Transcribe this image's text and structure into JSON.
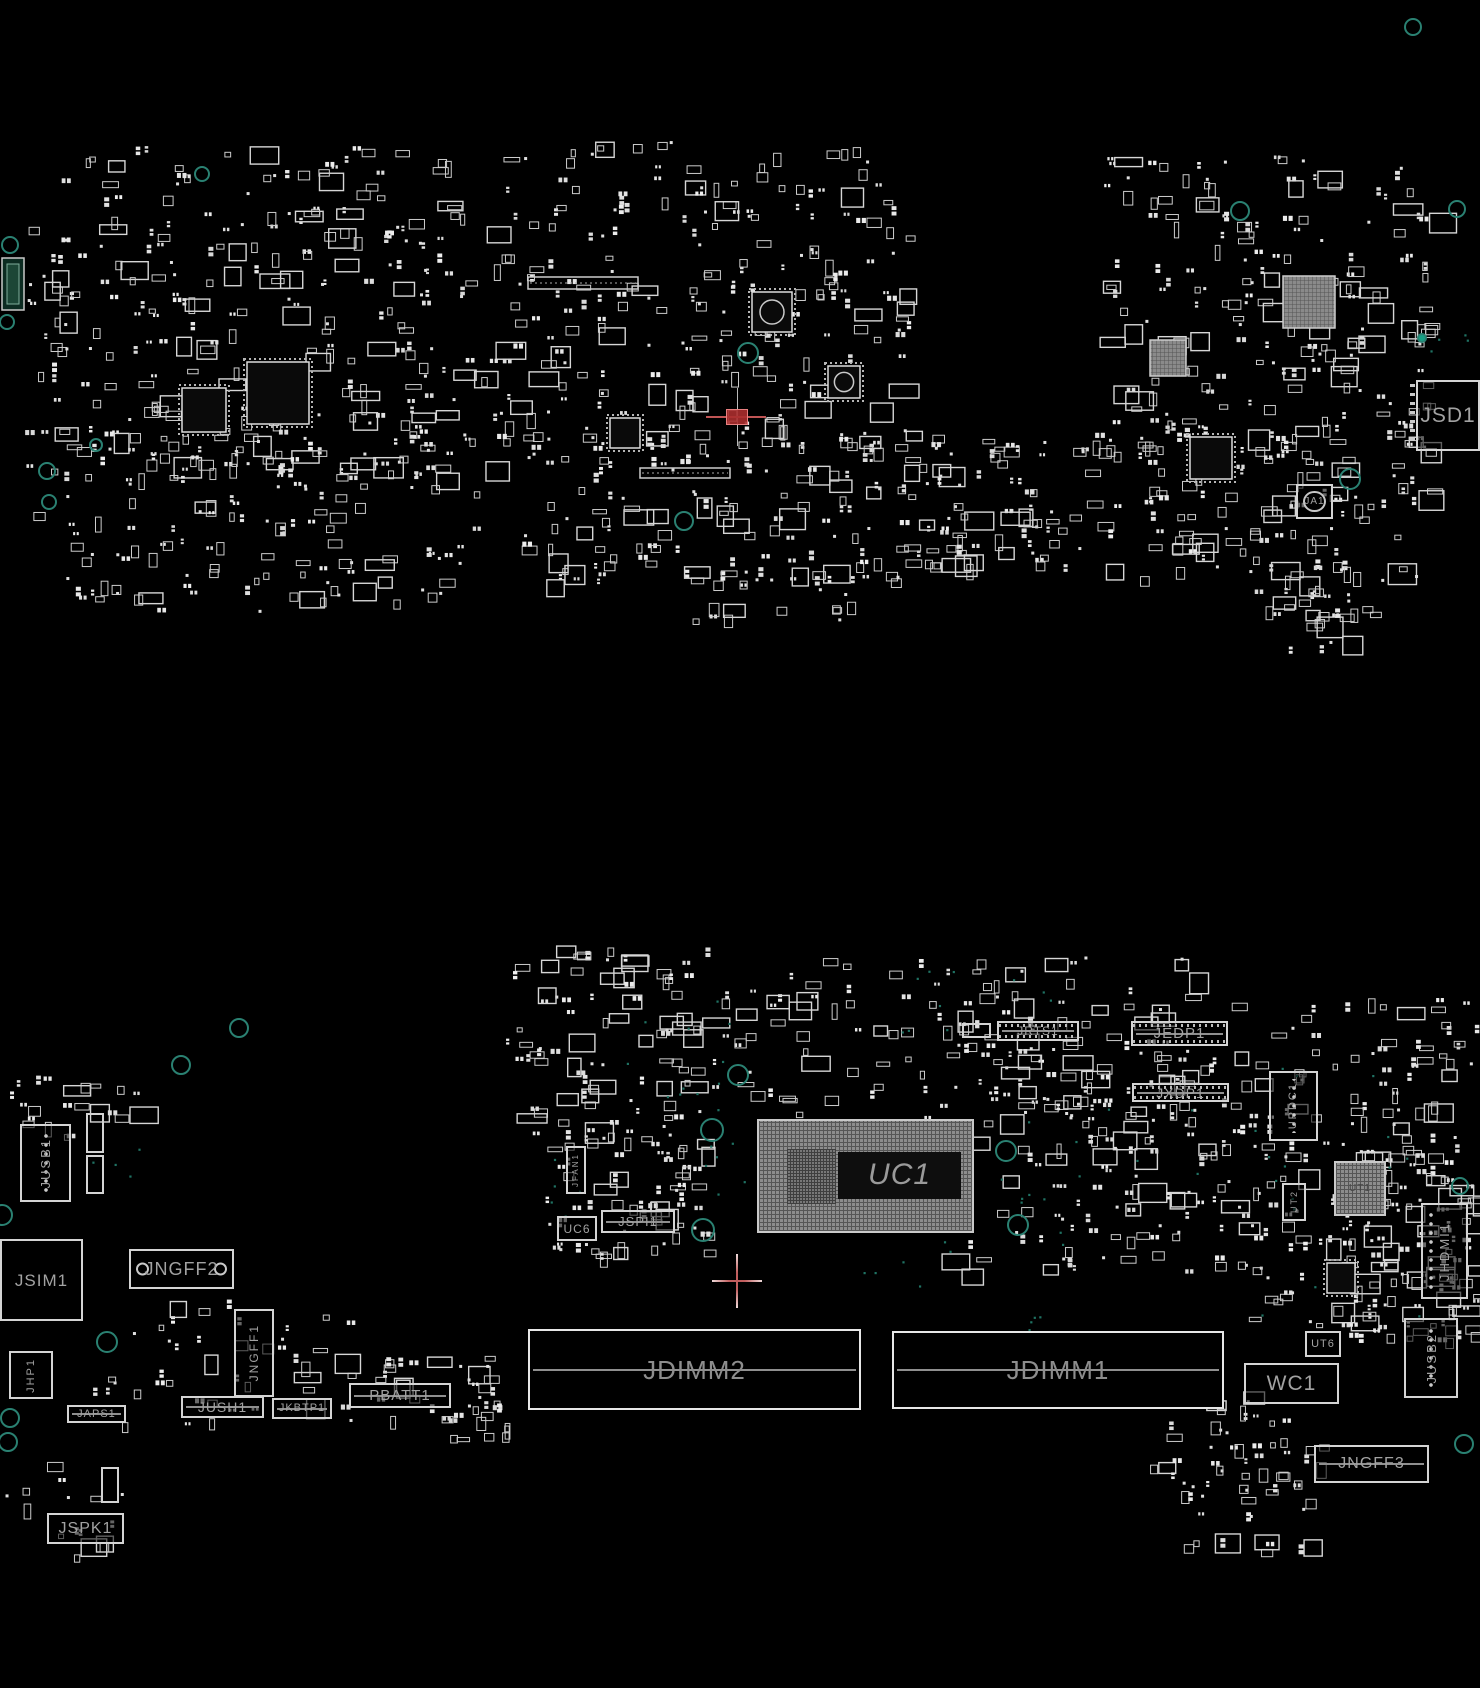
{
  "colors": {
    "background": "#000000",
    "silkscreen": "#d4d4d4",
    "label_gray": "#a2a2a2",
    "via_teal": "#2a8172",
    "crosshair_pink": "#c25e5e",
    "selection_red": "#aa2d2d"
  },
  "components": [
    {
      "label": "JSD1",
      "x": 1416,
      "y": 380,
      "w": 64,
      "h": 71,
      "fs": 21,
      "cls": "tick-l"
    },
    {
      "label": "JA1",
      "x": 1296,
      "y": 484,
      "w": 37,
      "h": 35,
      "fs": 10,
      "cls": "ring"
    },
    {
      "label": "JRTS1",
      "x": 997,
      "y": 1021,
      "w": 82,
      "h": 20,
      "fs": 12,
      "cls": "pins",
      "line": 1
    },
    {
      "label": "",
      "x": 962,
      "y": 1023,
      "w": 29,
      "h": 15
    },
    {
      "label": "JEDP1",
      "x": 1131,
      "y": 1021,
      "w": 97,
      "h": 25,
      "fs": 15,
      "cls": "pins",
      "line": 1
    },
    {
      "label": "JXDP1",
      "x": 1132,
      "y": 1083,
      "w": 97,
      "h": 19,
      "fs": 14,
      "cls": "pins",
      "line": 1
    },
    {
      "label": "UPDC1",
      "x": 1269,
      "y": 1071,
      "w": 49,
      "h": 70,
      "fs": 11,
      "cls": "vert",
      "holes": "c"
    },
    {
      "label": "UC1",
      "x": 757,
      "y": 1119,
      "w": 217,
      "h": 114,
      "fs": 30,
      "cls": "bga",
      "inner": 1
    },
    {
      "label": "UT1",
      "x": 1334,
      "y": 1161,
      "w": 52,
      "h": 55,
      "fs": 10,
      "cls": "bga faint"
    },
    {
      "label": "UT2",
      "x": 1282,
      "y": 1183,
      "w": 24,
      "h": 38,
      "fs": 9,
      "cls": "vert"
    },
    {
      "label": "JHDMI1",
      "x": 1421,
      "y": 1203,
      "w": 47,
      "h": 96,
      "fs": 13,
      "cls": "vert",
      "holes": "l"
    },
    {
      "label": "JUSB1",
      "x": 20,
      "y": 1124,
      "w": 51,
      "h": 78,
      "fs": 13,
      "cls": "vert",
      "holes": "c"
    },
    {
      "label": "",
      "x": 86,
      "y": 1113,
      "w": 18,
      "h": 40
    },
    {
      "label": "",
      "x": 86,
      "y": 1155,
      "w": 18,
      "h": 39
    },
    {
      "label": "JSIM1",
      "x": 0,
      "y": 1239,
      "w": 83,
      "h": 82,
      "fs": 17
    },
    {
      "label": "JNGFF2",
      "x": 129,
      "y": 1249,
      "w": 105,
      "h": 40,
      "fs": 18,
      "holes": "ends"
    },
    {
      "label": "JNGFF1",
      "x": 234,
      "y": 1309,
      "w": 40,
      "h": 88,
      "fs": 12,
      "cls": "vert"
    },
    {
      "label": "JHP1",
      "x": 9,
      "y": 1351,
      "w": 44,
      "h": 48,
      "fs": 11,
      "cls": "vert"
    },
    {
      "label": "JAPS1",
      "x": 67,
      "y": 1405,
      "w": 59,
      "h": 18,
      "fs": 11,
      "line": 1
    },
    {
      "label": "JUSH1",
      "x": 181,
      "y": 1396,
      "w": 83,
      "h": 22,
      "fs": 14,
      "line": 1
    },
    {
      "label": "JKBTP1",
      "x": 272,
      "y": 1398,
      "w": 60,
      "h": 21,
      "fs": 11,
      "line": 1
    },
    {
      "label": "PBATT1",
      "x": 349,
      "y": 1383,
      "w": 102,
      "h": 25,
      "fs": 15,
      "line": 1
    },
    {
      "label": "JSPK1",
      "x": 47,
      "y": 1513,
      "w": 77,
      "h": 31,
      "fs": 16
    },
    {
      "label": "",
      "x": 101,
      "y": 1467,
      "w": 18,
      "h": 36
    },
    {
      "label": "JDIMM2",
      "x": 528,
      "y": 1329,
      "w": 333,
      "h": 81,
      "fs": 26,
      "cls": "slot",
      "line": 1
    },
    {
      "label": "JDIMM1",
      "x": 892,
      "y": 1331,
      "w": 332,
      "h": 78,
      "fs": 26,
      "cls": "slot",
      "line": 1
    },
    {
      "label": "WC1",
      "x": 1244,
      "y": 1363,
      "w": 95,
      "h": 41,
      "fs": 21
    },
    {
      "label": "UT6",
      "x": 1305,
      "y": 1331,
      "w": 36,
      "h": 26,
      "fs": 11
    },
    {
      "label": "JUSB2",
      "x": 1404,
      "y": 1318,
      "w": 54,
      "h": 80,
      "fs": 13,
      "cls": "vert",
      "holes": "c"
    },
    {
      "label": "JNGFF3",
      "x": 1314,
      "y": 1445,
      "w": 115,
      "h": 38,
      "fs": 16,
      "line": 1
    },
    {
      "label": "JFAN1",
      "x": 566,
      "y": 1146,
      "w": 20,
      "h": 48,
      "fs": 8,
      "cls": "vert"
    },
    {
      "label": "UC6",
      "x": 557,
      "y": 1216,
      "w": 40,
      "h": 25,
      "fs": 12
    },
    {
      "label": "JSPI1",
      "x": 601,
      "y": 1210,
      "w": 74,
      "h": 23,
      "fs": 13,
      "line": 1
    }
  ],
  "chips": [
    {
      "t": "qfp",
      "x": 247,
      "y": 362,
      "w": 62,
      "h": 62
    },
    {
      "t": "qfp",
      "x": 182,
      "y": 388,
      "w": 44,
      "h": 44
    },
    {
      "t": "qfp",
      "x": 752,
      "y": 292,
      "w": 40,
      "h": 40,
      "c": 1
    },
    {
      "t": "qfp",
      "x": 828,
      "y": 366,
      "w": 32,
      "h": 32,
      "c": 1
    },
    {
      "t": "qfp",
      "x": 610,
      "y": 418,
      "w": 30,
      "h": 30
    },
    {
      "t": "qfp",
      "x": 1190,
      "y": 437,
      "w": 42,
      "h": 42
    },
    {
      "t": "qfp",
      "x": 1327,
      "y": 1263,
      "w": 28,
      "h": 30
    },
    {
      "t": "bga",
      "x": 1283,
      "y": 276,
      "w": 52,
      "h": 52
    },
    {
      "t": "bga",
      "x": 1150,
      "y": 340,
      "w": 36,
      "h": 36
    },
    {
      "t": "bar",
      "x": 528,
      "y": 277,
      "w": 110,
      "h": 12
    },
    {
      "t": "bar",
      "x": 640,
      "y": 468,
      "w": 90,
      "h": 10
    },
    {
      "t": "edge",
      "x": 2,
      "y": 258,
      "w": 22,
      "h": 52
    }
  ],
  "clusters": [
    [
      55,
      146,
      420,
      330,
      260,
      1
    ],
    [
      60,
      430,
      420,
      180,
      140,
      2
    ],
    [
      480,
      140,
      430,
      330,
      260,
      3
    ],
    [
      520,
      430,
      420,
      150,
      120,
      4
    ],
    [
      900,
      430,
      215,
      135,
      85,
      5
    ],
    [
      1100,
      155,
      330,
      300,
      200,
      6
    ],
    [
      1130,
      420,
      300,
      160,
      110,
      7
    ],
    [
      25,
      225,
      40,
      300,
      26,
      8
    ],
    [
      1280,
      585,
      95,
      70,
      16,
      9
    ],
    [
      610,
      560,
      250,
      60,
      25,
      11
    ],
    [
      1240,
      560,
      120,
      60,
      18,
      12
    ],
    [
      505,
      945,
      210,
      190,
      95,
      14
    ],
    [
      720,
      950,
      470,
      170,
      130,
      15
    ],
    [
      940,
      1040,
      290,
      230,
      140,
      16
    ],
    [
      1230,
      995,
      245,
      345,
      190,
      17
    ],
    [
      1345,
      1150,
      130,
      195,
      70,
      18
    ],
    [
      0,
      1075,
      135,
      60,
      22,
      19
    ],
    [
      90,
      1295,
      260,
      130,
      45,
      20
    ],
    [
      375,
      1355,
      120,
      70,
      28,
      21
    ],
    [
      1150,
      1390,
      170,
      110,
      45,
      22
    ],
    [
      1180,
      1480,
      130,
      70,
      22,
      23
    ],
    [
      545,
      1135,
      160,
      120,
      70,
      24
    ],
    [
      440,
      1400,
      70,
      40,
      14,
      25
    ],
    [
      5,
      1455,
      120,
      100,
      16,
      27
    ]
  ],
  "rings": [
    [
      202,
      174,
      7
    ],
    [
      10,
      245,
      8
    ],
    [
      7,
      322,
      7
    ],
    [
      47,
      471,
      8
    ],
    [
      49,
      502,
      7
    ],
    [
      96,
      445,
      6
    ],
    [
      684,
      521,
      9
    ],
    [
      748,
      353,
      10
    ],
    [
      1240,
      211,
      9
    ],
    [
      1457,
      209,
      8
    ],
    [
      1413,
      27,
      8
    ],
    [
      1350,
      479,
      10
    ],
    [
      1422,
      338,
      4,
      1
    ],
    [
      239,
      1028,
      9
    ],
    [
      181,
      1065,
      9
    ],
    [
      738,
      1075,
      10
    ],
    [
      712,
      1130,
      11
    ],
    [
      1006,
      1151,
      10
    ],
    [
      1018,
      1225,
      10
    ],
    [
      703,
      1230,
      11
    ],
    [
      2,
      1215,
      10
    ],
    [
      107,
      1342,
      10
    ],
    [
      10,
      1418,
      9
    ],
    [
      8,
      1442,
      9
    ],
    [
      1460,
      1186,
      8
    ],
    [
      1464,
      1444,
      9
    ]
  ],
  "dots": [
    [
      620,
      990,
      120,
      120,
      12,
      31
    ],
    [
      900,
      960,
      200,
      100,
      10,
      32
    ],
    [
      1000,
      1100,
      200,
      150,
      14,
      33
    ],
    [
      1240,
      1060,
      200,
      260,
      16,
      34
    ],
    [
      700,
      1140,
      60,
      60,
      6,
      35
    ],
    [
      540,
      1140,
      40,
      80,
      5,
      36
    ],
    [
      860,
      1230,
      120,
      60,
      6,
      37
    ],
    [
      1430,
      330,
      40,
      40,
      4,
      38
    ],
    [
      80,
      1120,
      60,
      60,
      4,
      39
    ],
    [
      980,
      1290,
      80,
      40,
      4,
      40
    ]
  ],
  "markers": {
    "crosshair": {
      "x": 737,
      "y": 1281,
      "arm_h": 25,
      "arm_v": 27
    },
    "selection": {
      "x": 737,
      "y": 417,
      "v_top": 388,
      "v_bottom": 446,
      "h_left": 706,
      "h_right": 766
    }
  }
}
